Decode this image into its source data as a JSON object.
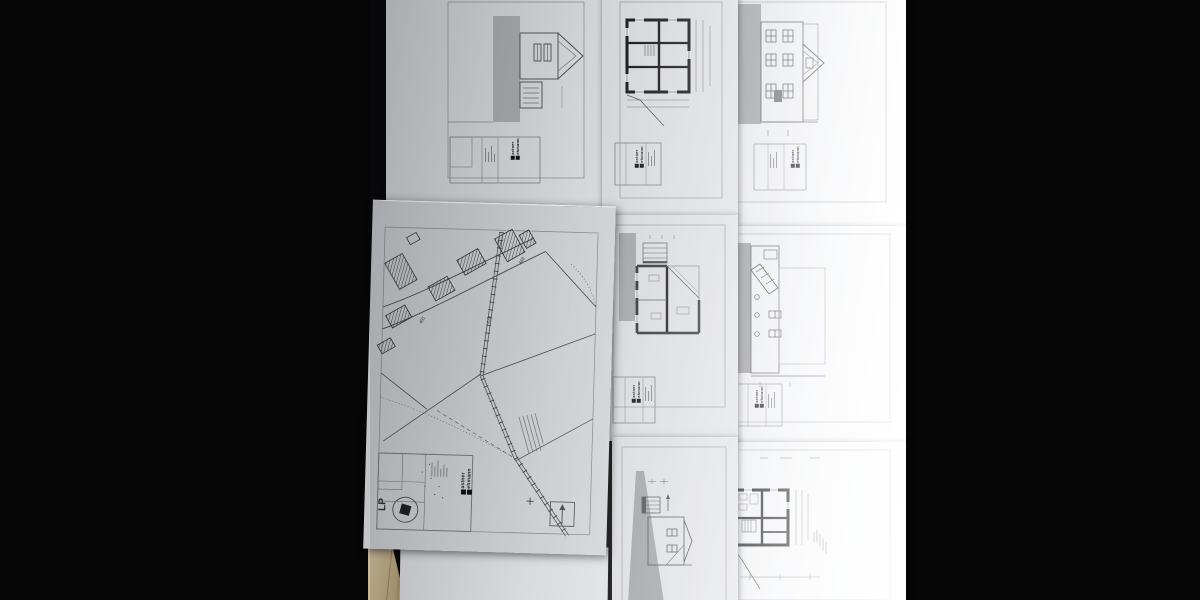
{
  "logo": {
    "line1": "astner",
    "line2": "ehmann"
  },
  "site_plan": {
    "stamp_label": "LP",
    "parcel_labels": [
      "468",
      "478",
      "481"
    ]
  }
}
